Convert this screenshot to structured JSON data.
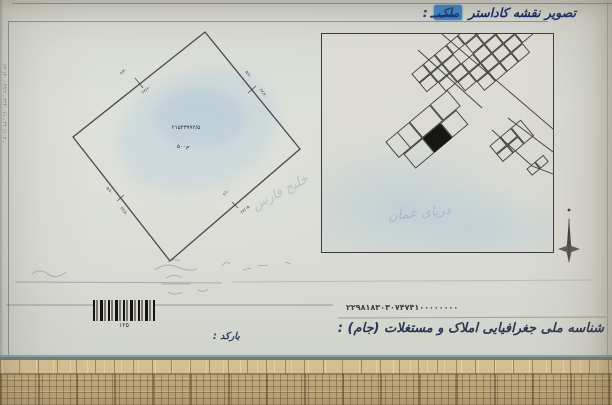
{
  "header": {
    "prefix": "تصویر نقشه کاداستر",
    "highlight": "ملک",
    "colon": ":"
  },
  "margin": {
    "note": "۶۳ ـ ۴۴۰/۱۰۳ ـ ۳۳۴۰۰۶۱ ـ ۴/۲۲ ـ ۱۳۰"
  },
  "left_map": {
    "center_line1": "۲۱۵۴۳۹۹۲/۵",
    "center_line2": "۵۰۰م",
    "watermark": "خلیج فارس",
    "edges": {
      "tl_a": "۶/۴۰",
      "tl_b": "۲۴/۶۰",
      "tr_a": "۵/۸۰",
      "tr_b": "۲۳/۲۰",
      "br_a": "۶/۱۰",
      "br_b": "۲۴/۱۵",
      "bl_a": "۵/۷۰",
      "bl_b": "۲۲/۸۰"
    }
  },
  "right_map": {
    "watermark": "دریای عمان"
  },
  "bottom": {
    "jam_number": "۲۲۹۸۱۸۳۰۳۰۷۴۷۴۱۰۰۰۰۰۰۰۰",
    "jam_label": "شناسه ملی جغرافیایی املاک و مستغلات (جام) :",
    "barcode_digits": "۱۲۵",
    "barcode_label": "بارکد :"
  },
  "colors": {
    "accent_blue": "#4186c8",
    "ink_navy": "#2b3650",
    "map_stroke": "#3f3e3a",
    "sea_wash": "#aec8d8",
    "mat_tan": "#c3a87c"
  }
}
